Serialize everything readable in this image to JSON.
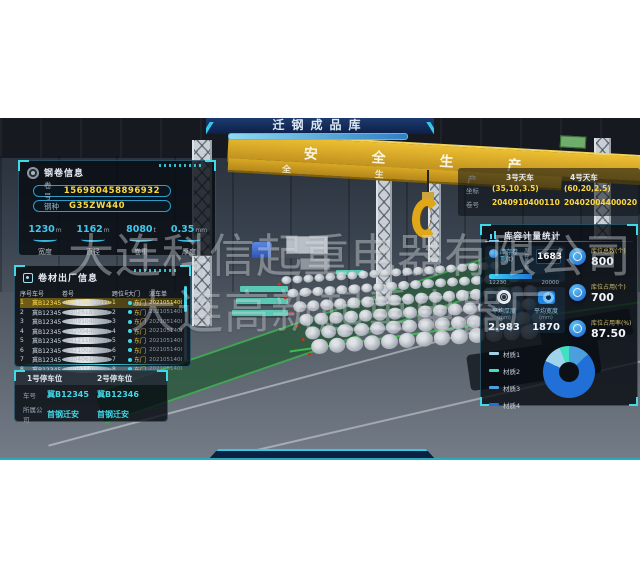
{
  "banner": {
    "title": "迁钢成品库"
  },
  "scene": {
    "beam_text": "安全生产",
    "beam2_text": "全生产",
    "watermark_line1": "大连科信起重电器有限公司",
    "watermark_line2": "大连高新起重电器厂"
  },
  "coil_info": {
    "title": "钢卷信息",
    "fields": [
      {
        "label": "卷号",
        "value": "156980458896932"
      },
      {
        "label": "钢种",
        "value": "G35ZW440"
      }
    ],
    "metrics": [
      {
        "value": "1230",
        "unit": "m",
        "label": "宽度"
      },
      {
        "value": "1162",
        "unit": "m",
        "label": "直径"
      },
      {
        "value": "8080",
        "unit": "t",
        "label": "卷重"
      },
      {
        "value": "0.35",
        "unit": "mm",
        "label": "厚度"
      }
    ]
  },
  "shipment": {
    "title": "卷材出厂信息",
    "columns": [
      "序号",
      "车号",
      "卷号",
      "跨位号",
      "大门",
      "派车单"
    ],
    "rows": [
      {
        "no": "1",
        "truck": "冀B12345",
        "coil": "2041100750110",
        "bay": "1",
        "gate": "东门",
        "order": "202105140001",
        "selected": true
      },
      {
        "no": "2",
        "truck": "冀B12345",
        "coil": "2030261830012",
        "bay": "2",
        "gate": "东门",
        "order": "202105140001",
        "selected": false
      },
      {
        "no": "3",
        "truck": "冀B12345",
        "coil": "2040910400110",
        "bay": "3",
        "gate": "东门",
        "order": "202105140001",
        "selected": false
      },
      {
        "no": "4",
        "truck": "冀B12345",
        "coil": "2042004400020",
        "bay": "4",
        "gate": "东门",
        "order": "202105140001",
        "selected": false
      },
      {
        "no": "5",
        "truck": "冀B12345",
        "coil": "2041211600010",
        "bay": "5",
        "gate": "东门",
        "order": "202105140001",
        "selected": false
      },
      {
        "no": "6",
        "truck": "冀B12345",
        "coil": "2042100200130",
        "bay": "6",
        "gate": "东门",
        "order": "202105140001",
        "selected": false
      },
      {
        "no": "7",
        "truck": "冀B12345",
        "coil": "2030406100010",
        "bay": "7",
        "gate": "东门",
        "order": "202105140001",
        "selected": false
      },
      {
        "no": "8",
        "truck": "冀B12345",
        "coil": "2030611400000",
        "bay": "8",
        "gate": "东门",
        "order": "202105140001",
        "selected": false
      }
    ]
  },
  "parking": {
    "plate_label": "车号",
    "company_label": "所属公司",
    "slots": [
      {
        "title": "1号停车位",
        "plate": "冀B12345",
        "company": "首钢迁安"
      },
      {
        "title": "2号停车位",
        "plate": "冀B12346",
        "company": "首钢迁安"
      }
    ]
  },
  "cranes": {
    "coord_label": "坐标",
    "coil_label": "卷号",
    "items": [
      {
        "name": "3号天车",
        "coord": "(35,10,3.5)",
        "coil": "2040910400110"
      },
      {
        "name": "4号天车",
        "coord": "(60,20,2.5)",
        "coil": "20402004400020"
      }
    ]
  },
  "stats": {
    "title": "库容计量统计",
    "inventory": {
      "label": "库存卷重(t)",
      "count_label": "库存卷数",
      "count": "1683",
      "current": "12230",
      "max": "20000"
    },
    "cards": [
      {
        "label": "平均厚度",
        "unit": "(mm)",
        "value": "2.983"
      },
      {
        "label": "平均宽度",
        "unit": "(mm)",
        "value": "1870"
      }
    ],
    "kpis": [
      {
        "label": "库位总数(个)",
        "value": "800"
      },
      {
        "label": "库位占用(个)",
        "value": "700"
      },
      {
        "label": "库位占用率(%)",
        "value": "87.50"
      }
    ]
  },
  "chart_data": {
    "type": "pie",
    "donut": true,
    "title": "",
    "categories": [
      "材质1",
      "材质2",
      "材质3",
      "材质4"
    ],
    "values": [
      12,
      6,
      13,
      69
    ],
    "colors": [
      "#9fd4ea",
      "#41e0c3",
      "#4b9fdd",
      "#2070d8"
    ],
    "draw_order": [
      2,
      3,
      0,
      1
    ],
    "legend_position": "left"
  },
  "colors": {
    "accent_cyan": "#3fd9e8",
    "value_yellow": "#ffd83d",
    "kpi_label_yellow": "#d8c06a",
    "crane_yellow": "#d9a825"
  }
}
